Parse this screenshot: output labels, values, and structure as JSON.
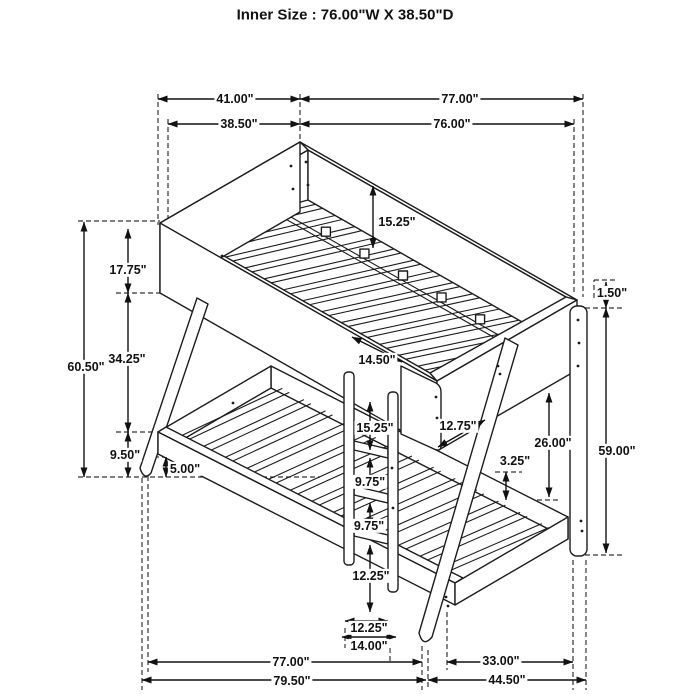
{
  "title": "Inner Size : 76.00\"W X  38.50\"D",
  "dims": {
    "depth_outer": "41.00\"",
    "length_outer": "77.00\"",
    "depth_inner": "38.50\"",
    "length_inner": "76.00\"",
    "overall_height": "60.50\"",
    "upper_rail_height": "17.75\"",
    "bunk_spacing": "34.25\"",
    "lower_frame_height": "9.50\"",
    "floor_clearance": "5.00\"",
    "upper_guard_depth": "15.25\"",
    "guard_gap_width": "14.50\"",
    "guard_panel_width": "12.75\"",
    "post_cap": "1.50\"",
    "post_height": "59.00\"",
    "under_bunk_clearance": "26.00\"",
    "rail_to_slat": "3.25\"",
    "ladder_step_top": "15.25\"",
    "rung_gap_1": "9.75\"",
    "rung_gap_2": "9.75\"",
    "rung_to_floor": "12.25\"",
    "ladder_inner_width": "12.25\"",
    "ladder_outer_width": "14.00\"",
    "lower_length": "77.00\"",
    "leg_extension": "33.00\"",
    "overall_length_left": "79.50\"",
    "overall_length_right": "44.50\""
  }
}
